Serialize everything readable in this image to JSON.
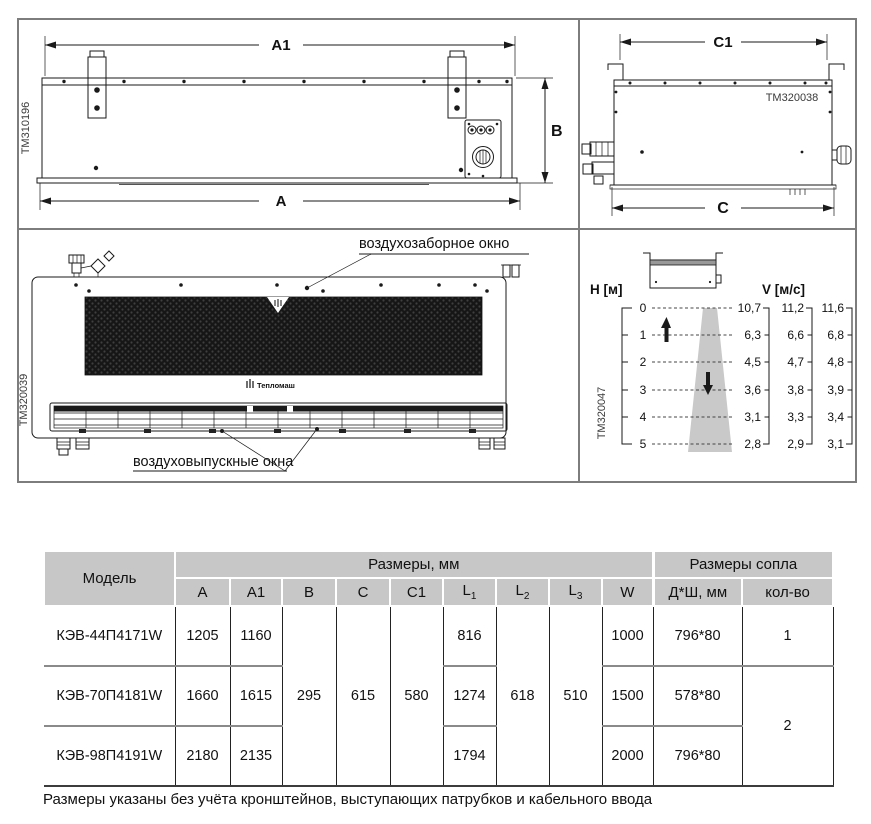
{
  "page": {
    "footnote": "Размеры указаны без учёта кронштейнов, выступающих патрубков и кабельного ввода"
  },
  "panels": {
    "rear_view": {
      "code": "TM310196",
      "dim_a1": "A1",
      "dim_a": "A",
      "dim_b": "B"
    },
    "side_view": {
      "code": "TM320038",
      "dim_c1": "C1",
      "dim_c": "C"
    },
    "front_view": {
      "code": "TM320039",
      "brand": "Тепломаш",
      "intake_label": "воздухозаборное окно",
      "outlet_label": "воздуховыпускные окна"
    },
    "airflow": {
      "code": "TM320047",
      "h_label": "H [м]",
      "v_label": "V [м/с]",
      "heights": [
        "0",
        "1",
        "2",
        "3",
        "4",
        "5"
      ],
      "v1": [
        "10,7",
        "6,3",
        "4,5",
        "3,6",
        "3,1",
        "2,8"
      ],
      "v2": [
        "11,2",
        "6,6",
        "4,7",
        "3,8",
        "3,3",
        "2,9"
      ],
      "v3": [
        "11,6",
        "6,8",
        "4,8",
        "3,9",
        "3,4",
        "3,1"
      ]
    }
  },
  "chart_data": {
    "type": "line",
    "x": [
      0,
      1,
      2,
      3,
      4,
      5
    ],
    "xlabel": "H [м]",
    "ylabel": "V [м/с]",
    "series": [
      {
        "name": "scale-1",
        "values": [
          10.7,
          6.3,
          4.5,
          3.6,
          3.1,
          2.8
        ]
      },
      {
        "name": "scale-2",
        "values": [
          11.2,
          6.6,
          4.7,
          3.8,
          3.3,
          2.9
        ]
      },
      {
        "name": "scale-3",
        "values": [
          11.6,
          6.8,
          4.8,
          3.9,
          3.4,
          3.1
        ]
      }
    ]
  },
  "table": {
    "header_model": "Модель",
    "group_dims": "Размеры, мм",
    "group_nozzle": "Размеры сопла",
    "cols": {
      "a": "A",
      "a1": "A1",
      "b": "B",
      "c": "C",
      "c1": "C1",
      "l": "L",
      "l_subs": [
        "1",
        "2",
        "3"
      ],
      "w": "W",
      "nozzle_size": "Д*Ш, мм",
      "nozzle_count": "кол-во"
    },
    "merged": {
      "b": "295",
      "c": "615",
      "c1": "580",
      "l2": "618",
      "l3": "510",
      "count_23": "2"
    },
    "rows": [
      {
        "model": "КЭВ-44П4171W",
        "a": "1205",
        "a1": "1160",
        "l1": "816",
        "w": "1000",
        "nozzle": "796*80",
        "count": "1"
      },
      {
        "model": "КЭВ-70П4181W",
        "a": "1660",
        "a1": "1615",
        "l1": "1274",
        "w": "1500",
        "nozzle": "578*80"
      },
      {
        "model": "КЭВ-98П4191W",
        "a": "2180",
        "a1": "2135",
        "l1": "1794",
        "w": "2000",
        "nozzle": "796*80"
      }
    ]
  }
}
